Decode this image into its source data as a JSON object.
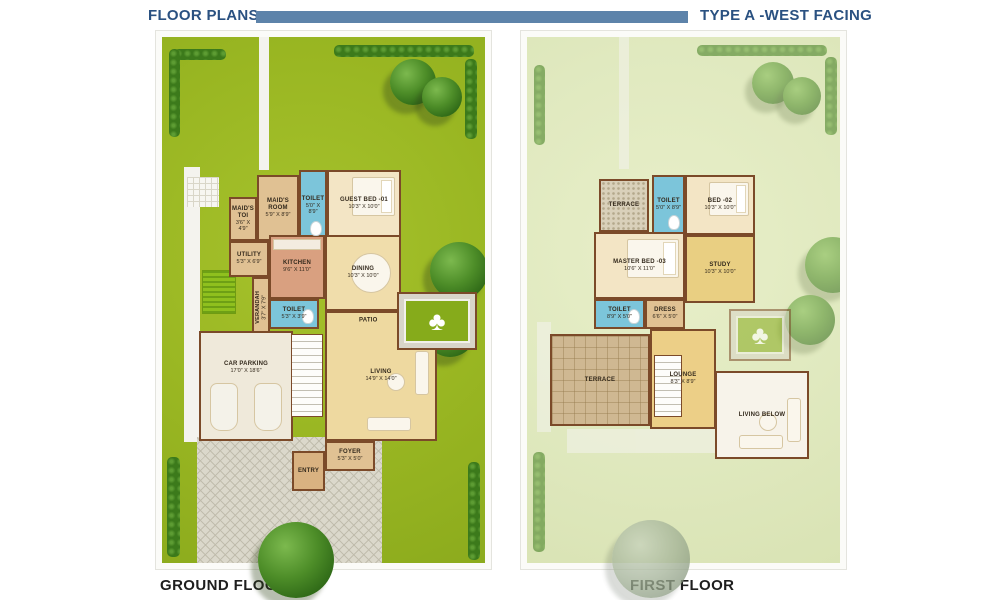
{
  "header": {
    "left_title": "FLOOR PLANS",
    "right_title": "TYPE A -WEST FACING",
    "bar_color": "#5d83aa",
    "title_color": "#2a5181"
  },
  "footer": {
    "ground_caption": "GROUND FLOOR",
    "first_caption": "FIRST FLOOR"
  },
  "colors": {
    "lawn_green": "#99b622",
    "faded_lawn": "#e0e9bf",
    "wall_brown": "#7b4a29",
    "toilet_blue": "#7cc5da",
    "kitchen_salmon": "#d9a080",
    "bedroom_cream": "#f3e5c5",
    "living_yellow": "#eed9a0"
  },
  "floors": [
    {
      "id": "ground",
      "caption": "GROUND FLOOR",
      "rooms": [
        {
          "slug": "maids-toi",
          "label": "MAID'S TOI",
          "dims": "3'6\" X 4'9\"",
          "type": "tan",
          "rect": [
            67,
            160,
            28,
            44
          ]
        },
        {
          "slug": "maids-room",
          "label": "MAID'S ROOM",
          "dims": "5'9\" X 8'9\"",
          "type": "tan",
          "rect": [
            95,
            138,
            42,
            66
          ]
        },
        {
          "slug": "toilet-top",
          "label": "TOILET",
          "dims": "5'0\" X 8'9\"",
          "type": "toilet",
          "rect": [
            137,
            133,
            28,
            71
          ]
        },
        {
          "slug": "guest-bed-01",
          "label": "GUEST BED -01",
          "dims": "10'3\" X 10'0\"",
          "type": "bedroom",
          "rect": [
            165,
            133,
            74,
            67
          ]
        },
        {
          "slug": "utility",
          "label": "UTILITY",
          "dims": "5'3\" X 6'9\"",
          "type": "tan",
          "rect": [
            67,
            204,
            40,
            36
          ]
        },
        {
          "slug": "verandah",
          "label": "VERANDAH",
          "dims": "3'7\" X 7'9\"",
          "type": "tan",
          "vertical": true,
          "rect": [
            90,
            240,
            18,
            60
          ]
        },
        {
          "slug": "kitchen",
          "label": "KITCHEN",
          "dims": "9'6\" X 11'0\"",
          "type": "kitchen",
          "rect": [
            107,
            198,
            56,
            64
          ]
        },
        {
          "slug": "dining",
          "label": "DINING",
          "dims": "10'3\" X 10'0\"",
          "type": "dining",
          "rect": [
            163,
            198,
            76,
            76
          ]
        },
        {
          "slug": "toilet-mid",
          "label": "TOILET",
          "dims": "5'3\" X 3'9\"",
          "type": "toilet",
          "rect": [
            107,
            262,
            50,
            30
          ]
        },
        {
          "slug": "car-parking",
          "label": "CAR PARKING",
          "dims": "17'0\" X 18'6\"",
          "type": "parking",
          "rect": [
            37,
            294,
            94,
            110
          ]
        },
        {
          "slug": "staircase",
          "label": "",
          "dims": "",
          "type": "stair",
          "rect": [
            129,
            297,
            32,
            83
          ]
        },
        {
          "slug": "living",
          "label": "LIVING",
          "dims": "14'9\" X 14'0\"",
          "type": "living",
          "rect": [
            163,
            274,
            112,
            130
          ]
        },
        {
          "slug": "patio",
          "label": "PATIO",
          "dims": "",
          "type": "patio",
          "rect": [
            235,
            255,
            80,
            58
          ]
        },
        {
          "slug": "foyer",
          "label": "FOYER",
          "dims": "5'3\" X 5'0\"",
          "type": "tan",
          "rect": [
            163,
            404,
            50,
            30
          ]
        },
        {
          "slug": "entry",
          "label": "ENTRY",
          "dims": "",
          "type": "entry",
          "rect": [
            130,
            414,
            33,
            40
          ]
        }
      ]
    },
    {
      "id": "first",
      "caption": "FIRST FLOOR",
      "rooms": [
        {
          "slug": "terrace-top",
          "label": "TERRACE",
          "dims": "",
          "type": "terraceHatch",
          "rect": [
            72,
            142,
            50,
            53
          ]
        },
        {
          "slug": "toilet-f1",
          "label": "TOILET",
          "dims": "5'0\" X 8'9\"",
          "type": "toilet",
          "rect": [
            125,
            138,
            33,
            60
          ]
        },
        {
          "slug": "bed-02",
          "label": "BED -02",
          "dims": "10'3\" X 10'0\"",
          "type": "bedroom",
          "rect": [
            158,
            138,
            70,
            60
          ]
        },
        {
          "slug": "master-bed-03",
          "label": "MASTER BED -03",
          "dims": "10'6\" X 11'0\"",
          "type": "bedroom",
          "rect": [
            67,
            195,
            91,
            67
          ]
        },
        {
          "slug": "study",
          "label": "STUDY",
          "dims": "10'3\" X 10'0\"",
          "type": "study",
          "rect": [
            158,
            198,
            70,
            68
          ]
        },
        {
          "slug": "toilet-f2",
          "label": "TOILET",
          "dims": "8'9\" X 5'0\"",
          "type": "toilet",
          "rect": [
            67,
            262,
            51,
            30
          ]
        },
        {
          "slug": "dress",
          "label": "DRESS",
          "dims": "6'6\" X 5'0\"",
          "type": "tan",
          "rect": [
            118,
            262,
            40,
            30
          ]
        },
        {
          "slug": "terrace-big",
          "label": "TERRACE",
          "dims": "",
          "type": "terraceGrid",
          "rect": [
            23,
            297,
            100,
            92
          ]
        },
        {
          "slug": "lounge",
          "label": "LOUNGE",
          "dims": "8'3\" X 8'9\"",
          "type": "lounge",
          "rect": [
            123,
            292,
            66,
            100
          ]
        },
        {
          "slug": "stair-f",
          "label": "",
          "dims": "",
          "type": "stair",
          "rect": [
            127,
            318,
            28,
            62
          ]
        },
        {
          "slug": "patio-below",
          "label": "",
          "dims": "",
          "type": "patioFaded",
          "rect": [
            202,
            272,
            62,
            52
          ]
        },
        {
          "slug": "living-below",
          "label": "LIVING BELOW",
          "dims": "",
          "type": "whiteroom",
          "rect": [
            188,
            334,
            94,
            88
          ]
        }
      ]
    }
  ]
}
